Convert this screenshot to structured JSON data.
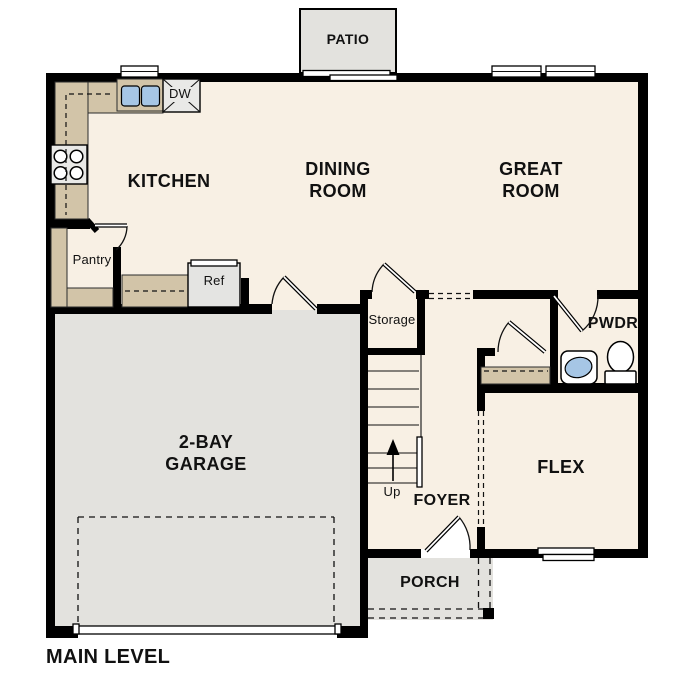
{
  "plan": {
    "title": "MAIN LEVEL",
    "rooms": {
      "patio": "PATIO",
      "kitchen": "KITCHEN",
      "dining_line1": "DINING",
      "dining_line2": "ROOM",
      "great_line1": "GREAT",
      "great_line2": "ROOM",
      "garage_line1": "2-BAY",
      "garage_line2": "GARAGE",
      "flex": "FLEX",
      "foyer": "FOYER",
      "porch": "PORCH",
      "pwdr": "PWDR",
      "storage": "Storage",
      "pantry": "Pantry"
    },
    "fixtures": {
      "dishwasher": "DW",
      "refrigerator": "Ref",
      "stairs_direction": "Up"
    },
    "colors": {
      "floor": "#f8f0e4",
      "hard_surface": "#e3e2de",
      "counter": "#d2c4a8",
      "water": "#a6c6e5",
      "appliance": "#e9e9e7",
      "wall": "#000000"
    }
  }
}
